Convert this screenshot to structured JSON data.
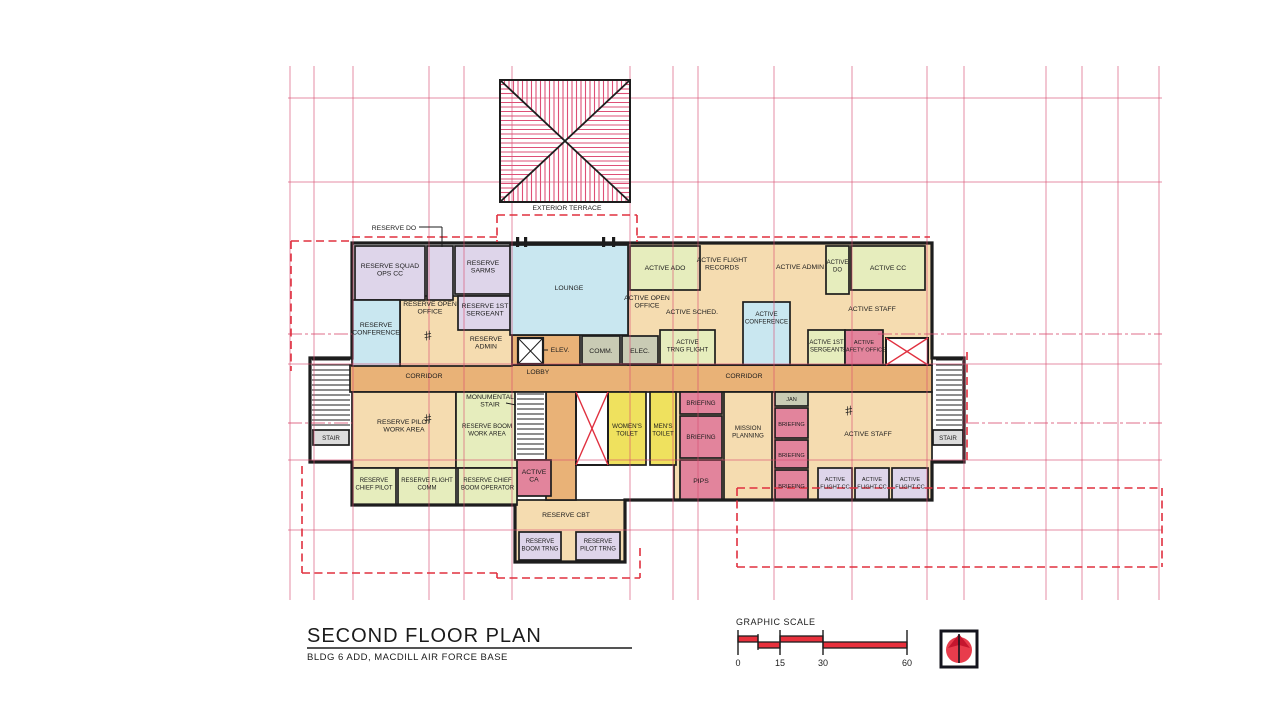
{
  "title_block": {
    "title": "SECOND FLOOR PLAN",
    "subtitle": "BLDG 6 ADD, MACDILL AIR FORCE BASE"
  },
  "scale_bar": {
    "label": "GRAPHIC SCALE",
    "ticks": [
      {
        "t": "0",
        "x": 738
      },
      {
        "t": "15",
        "x": 780
      },
      {
        "t": "30",
        "x": 823
      },
      {
        "t": "60",
        "x": 907
      }
    ],
    "half_tick_x": 758,
    "top_bars": [
      [
        738,
        758
      ],
      [
        780,
        823
      ]
    ],
    "bottom_bars": [
      [
        758,
        780
      ],
      [
        823,
        907
      ]
    ]
  },
  "colors": {
    "tan": "#f5dcb0",
    "corridor": "#e9b277",
    "green": "#e6edbd",
    "lavender": "#ded5ea",
    "blue": "#c9e7f0",
    "pink": "#e2849c",
    "yellow": "#efe15e",
    "gray": "#c9cbb4",
    "stair_gray": "#dcdcdc",
    "white": "#ffffff",
    "wall": "#1d1d1d",
    "grid": "#d84a6e",
    "dash_red": "#e0303f",
    "hatch": "#de5077"
  },
  "plan": {
    "grid": {
      "verticals": [
        290,
        314,
        353,
        429,
        464,
        512,
        630,
        673,
        698,
        774,
        852,
        927,
        964,
        1046,
        1082,
        1118,
        1159
      ],
      "v_extent": [
        66,
        600
      ],
      "horizontals": [
        98,
        182,
        364,
        460,
        530
      ],
      "h_extent": [
        288,
        1162
      ],
      "partials": [
        [
          288,
          334,
          352,
          334
        ],
        [
          878,
          334,
          1162,
          334
        ],
        [
          288,
          423,
          352,
          423
        ],
        [
          965,
          423,
          1162,
          423
        ]
      ]
    },
    "outline_path": "M352,243 H932 V358 H964 V462 H932 V500 H625 V562 H515 V505 H352 V462 H310 V358 H352 Z",
    "fills": [
      {
        "name": "corridor-main",
        "x": 350,
        "y": 365,
        "w": 582,
        "h": 27,
        "color": "corridor"
      },
      {
        "name": "lobby-upper",
        "x": 510,
        "y": 335,
        "w": 70,
        "h": 30,
        "color": "corridor"
      },
      {
        "name": "active-open-area",
        "x": 628,
        "y": 243,
        "w": 304,
        "h": 122,
        "color": "tan"
      },
      {
        "name": "reserve-open-area",
        "x": 400,
        "y": 296,
        "w": 112,
        "h": 70,
        "color": "tan"
      },
      {
        "name": "bottom-right-open-area",
        "x": 674,
        "y": 392,
        "w": 258,
        "h": 108,
        "color": "tan"
      },
      {
        "name": "room-reserve-cbt",
        "x": 515,
        "y": 500,
        "w": 110,
        "h": 62,
        "color": "tan"
      },
      {
        "name": "corridor-vertical",
        "x": 546,
        "y": 392,
        "w": 30,
        "h": 108,
        "color": "corridor"
      },
      {
        "name": "room-reserve-squad-ops-cc",
        "x": 355,
        "y": 246,
        "w": 70,
        "h": 54,
        "color": "lavender",
        "label": [
          "RESERVE SQUAD",
          "OPS CC"
        ],
        "ly": 268
      },
      {
        "name": "room-reserve-do",
        "x": 427,
        "y": 246,
        "w": 26,
        "h": 54,
        "color": "lavender"
      },
      {
        "name": "room-reserve-sarms",
        "x": 455,
        "y": 246,
        "w": 56,
        "h": 48,
        "color": "lavender",
        "label": [
          "RESERVE",
          "SARMS"
        ],
        "ly": 265
      },
      {
        "name": "room-reserve-conference",
        "x": 352,
        "y": 300,
        "w": 48,
        "h": 66,
        "color": "blue",
        "label": [
          "RESERVE",
          "CONFERENCE"
        ],
        "ly": 327
      },
      {
        "name": "room-reserve-1st-sergeant",
        "x": 458,
        "y": 296,
        "w": 54,
        "h": 34,
        "color": "lavender",
        "label": [
          "RESERVE 1ST",
          "SERGEANT"
        ],
        "ly": 308
      },
      {
        "name": "room-lounge",
        "x": 510,
        "y": 245,
        "w": 118,
        "h": 90,
        "color": "blue",
        "label": [
          "LOUNGE"
        ],
        "ly": 290
      },
      {
        "name": "room-active-ado",
        "x": 630,
        "y": 246,
        "w": 70,
        "h": 44,
        "color": "green",
        "label": [
          "ACTIVE ADO"
        ],
        "ly": 270
      },
      {
        "name": "room-active-do",
        "x": 826,
        "y": 246,
        "w": 23,
        "h": 48,
        "color": "green",
        "label": [
          "ACTIVE",
          "DO"
        ],
        "ly": 264,
        "fs": 6
      },
      {
        "name": "room-active-cc",
        "x": 851,
        "y": 246,
        "w": 74,
        "h": 44,
        "color": "green",
        "label": [
          "ACTIVE CC"
        ],
        "ly": 270
      },
      {
        "name": "room-active-conference",
        "x": 743,
        "y": 302,
        "w": 47,
        "h": 63,
        "color": "blue",
        "label": [
          "ACTIVE",
          "CONFERENCE"
        ],
        "ly": 316,
        "fs": 6.2
      },
      {
        "name": "room-active-1st-sergeant",
        "x": 808,
        "y": 330,
        "w": 37,
        "h": 35,
        "color": "green",
        "label": [
          "ACTIVE 1ST",
          "SERGEANT"
        ],
        "ly": 344,
        "fs": 6
      },
      {
        "name": "room-active-safety-office",
        "x": 845,
        "y": 330,
        "w": 38,
        "h": 35,
        "color": "pink",
        "label": [
          "ACTIVE",
          "SAFETY OFFICE"
        ],
        "ly": 344,
        "fs": 5.6
      },
      {
        "name": "room-comm",
        "x": 582,
        "y": 336,
        "w": 38,
        "h": 28,
        "color": "gray",
        "label": [
          "COMM."
        ],
        "ly": 353
      },
      {
        "name": "room-elec",
        "x": 622,
        "y": 336,
        "w": 36,
        "h": 28,
        "color": "gray",
        "label": [
          "ELEC."
        ],
        "ly": 353
      },
      {
        "name": "room-active-trng-flight",
        "x": 660,
        "y": 330,
        "w": 55,
        "h": 35,
        "color": "green",
        "label": [
          "ACTIVE",
          "TRNG FLIGHT"
        ],
        "ly": 344,
        "fs": 6.2
      },
      {
        "name": "room-reserve-pilot-work-area",
        "x": 352,
        "y": 392,
        "w": 104,
        "h": 76,
        "color": "tan",
        "label": [
          "RESERVE PILOT",
          "WORK AREA"
        ],
        "ly": 424
      },
      {
        "name": "room-reserve-boom-work-area",
        "x": 456,
        "y": 392,
        "w": 62,
        "h": 76,
        "color": "green",
        "label": [
          "RESERVE BOOM",
          "WORK AREA"
        ],
        "ly": 428,
        "fs": 6.2
      },
      {
        "name": "monumental-stair-well",
        "x": 515,
        "y": 392,
        "w": 31,
        "h": 68,
        "color": "white"
      },
      {
        "name": "room-active-ca",
        "x": 517,
        "y": 460,
        "w": 34,
        "h": 36,
        "color": "pink",
        "label": [
          "ACTIVE",
          "CA"
        ],
        "ly": 474
      },
      {
        "name": "room-womens-toilet",
        "x": 608,
        "y": 392,
        "w": 38,
        "h": 73,
        "color": "yellow",
        "label": [
          "WOMEN'S",
          "TOILET"
        ],
        "ly": 428,
        "fs": 6.2
      },
      {
        "name": "room-mens-toilet",
        "x": 650,
        "y": 392,
        "w": 26,
        "h": 73,
        "color": "yellow",
        "label": [
          "MEN'S",
          "TOILET"
        ],
        "ly": 428,
        "fs": 6.2
      },
      {
        "name": "room-briefing-1",
        "x": 680,
        "y": 392,
        "w": 42,
        "h": 22,
        "color": "pink",
        "label": [
          "BRIEFING"
        ],
        "ly": 405,
        "fs": 6.2
      },
      {
        "name": "room-briefing-2",
        "x": 680,
        "y": 416,
        "w": 42,
        "h": 42,
        "color": "pink",
        "label": [
          "BRIEFING"
        ],
        "ly": 439,
        "fs": 6.2
      },
      {
        "name": "room-pips",
        "x": 680,
        "y": 460,
        "w": 42,
        "h": 40,
        "color": "pink",
        "label": [
          "PIPS"
        ],
        "ly": 483
      },
      {
        "name": "room-mission-planning",
        "x": 724,
        "y": 392,
        "w": 48,
        "h": 108,
        "color": "tan",
        "label": [
          "MISSION",
          "PLANNING"
        ],
        "ly": 430,
        "fs": 6.2
      },
      {
        "name": "room-jan",
        "x": 775,
        "y": 392,
        "w": 33,
        "h": 14,
        "color": "gray",
        "label": [
          "JAN"
        ],
        "ly": 401,
        "fs": 5.6
      },
      {
        "name": "room-briefing-r1",
        "x": 775,
        "y": 408,
        "w": 33,
        "h": 30,
        "color": "pink",
        "label": [
          "BRIEFING"
        ],
        "ly": 426,
        "fs": 5.6
      },
      {
        "name": "room-briefing-r2",
        "x": 775,
        "y": 440,
        "w": 33,
        "h": 28,
        "color": "pink",
        "label": [
          "BRIEFING"
        ],
        "ly": 457,
        "fs": 5.6
      },
      {
        "name": "room-briefing-r3",
        "x": 775,
        "y": 470,
        "w": 33,
        "h": 30,
        "color": "pink",
        "label": [
          "BRIEFING"
        ],
        "ly": 488,
        "fs": 5.6
      },
      {
        "name": "room-active-flight-cc-1",
        "x": 818,
        "y": 468,
        "w": 34,
        "h": 32,
        "color": "lavender",
        "label": [
          "ACTIVE",
          "FLIGHT CC"
        ],
        "ly": 481,
        "fs": 5.6
      },
      {
        "name": "room-active-flight-cc-2",
        "x": 855,
        "y": 468,
        "w": 34,
        "h": 32,
        "color": "lavender",
        "label": [
          "ACTIVE",
          "FLIGHT CC"
        ],
        "ly": 481,
        "fs": 5.6
      },
      {
        "name": "room-active-flight-cc-3",
        "x": 892,
        "y": 468,
        "w": 36,
        "h": 32,
        "color": "lavender",
        "label": [
          "ACTIVE",
          "FLIGHT CC"
        ],
        "ly": 481,
        "fs": 5.6
      },
      {
        "name": "room-reserve-chief-pilot",
        "x": 352,
        "y": 468,
        "w": 44,
        "h": 37,
        "color": "green",
        "label": [
          "RESERVE",
          "CHIEF PILOT"
        ],
        "ly": 482,
        "fs": 6
      },
      {
        "name": "room-reserve-flight-comm",
        "x": 398,
        "y": 468,
        "w": 58,
        "h": 37,
        "color": "green",
        "label": [
          "RESERVE FLIGHT",
          "COMM"
        ],
        "ly": 482,
        "fs": 6
      },
      {
        "name": "room-reserve-chief-boom-operator",
        "x": 458,
        "y": 468,
        "w": 59,
        "h": 37,
        "color": "green",
        "label": [
          "RESERVE CHIEF",
          "BOOM OPERATOR"
        ],
        "ly": 482,
        "fs": 6
      },
      {
        "name": "room-reserve-boom-trng",
        "x": 519,
        "y": 532,
        "w": 42,
        "h": 28,
        "color": "lavender",
        "label": [
          "RESERVE",
          "BOOM TRNG"
        ],
        "ly": 543,
        "fs": 6
      },
      {
        "name": "room-reserve-pilot-trng",
        "x": 576,
        "y": 532,
        "w": 44,
        "h": 28,
        "color": "lavender",
        "label": [
          "RESERVE",
          "PILOT TRNG"
        ],
        "ly": 543,
        "fs": 6
      },
      {
        "name": "stair-label-left",
        "x": 313,
        "y": 430,
        "w": 36,
        "h": 15,
        "color": "stair_gray",
        "label": [
          "STAIR"
        ],
        "ly": 440,
        "fs": 6.2
      },
      {
        "name": "stair-label-right",
        "x": 933,
        "y": 430,
        "w": 30,
        "h": 15,
        "color": "stair_gray",
        "label": [
          "STAIR"
        ],
        "ly": 440,
        "fs": 6.2
      }
    ],
    "free_labels": [
      {
        "name": "label-reserve-open-office",
        "lines": [
          "RESERVE OPEN",
          "OFFICE"
        ],
        "x": 430,
        "y": 306
      },
      {
        "name": "label-reserve-admin",
        "lines": [
          "RESERVE",
          "ADMIN"
        ],
        "x": 486,
        "y": 341
      },
      {
        "name": "label-active-flight-records",
        "lines": [
          "ACTIVE FLIGHT",
          "RECORDS"
        ],
        "x": 722,
        "y": 262
      },
      {
        "name": "label-active-admin",
        "lines": [
          "ACTIVE ADMIN"
        ],
        "x": 800,
        "y": 269
      },
      {
        "name": "label-active-open-office",
        "lines": [
          "ACTIVE OPEN",
          "OFFICE"
        ],
        "x": 647,
        "y": 300
      },
      {
        "name": "label-active-sched",
        "lines": [
          "ACTIVE SCHED."
        ],
        "x": 692,
        "y": 314
      },
      {
        "name": "label-active-staff-top",
        "lines": [
          "ACTIVE STAFF"
        ],
        "x": 872,
        "y": 311
      },
      {
        "name": "label-active-staff-bottom",
        "lines": [
          "ACTIVE STAFF"
        ],
        "x": 868,
        "y": 436
      },
      {
        "name": "label-corridor-left",
        "lines": [
          "CORRIDOR"
        ],
        "x": 424,
        "y": 378
      },
      {
        "name": "label-lobby",
        "lines": [
          "LOBBY"
        ],
        "x": 538,
        "y": 374
      },
      {
        "name": "label-corridor-right",
        "lines": [
          "CORRIDOR"
        ],
        "x": 744,
        "y": 378
      },
      {
        "name": "label-reserve-cbt",
        "lines": [
          "RESERVE CBT"
        ],
        "x": 566,
        "y": 517
      },
      {
        "name": "label-exterior-terrace",
        "lines": [
          "EXTERIOR TERRACE"
        ],
        "x": 567,
        "y": 210
      },
      {
        "name": "label-reserve-do",
        "lines": [
          "RESERVE DO"
        ],
        "x": 394,
        "y": 230
      },
      {
        "name": "label-elev",
        "lines": [
          "ELEV."
        ],
        "x": 560,
        "y": 352
      },
      {
        "name": "label-monumental-stair",
        "lines": [
          "MONUMENTAL",
          "STAIR"
        ],
        "x": 490,
        "y": 399
      }
    ],
    "stairs": [
      {
        "x": 312,
        "y": 360,
        "w": 38,
        "h": 70,
        "step": 5
      },
      {
        "x": 936,
        "y": 360,
        "w": 26,
        "h": 70,
        "step": 5
      },
      {
        "x": 517,
        "y": 394,
        "w": 27,
        "h": 64,
        "step": 5
      }
    ],
    "xboxes": [
      {
        "x": 576,
        "y": 392,
        "w": 32,
        "h": 73
      },
      {
        "x": 886,
        "y": 338,
        "w": 42,
        "h": 27
      }
    ],
    "elevator": {
      "x": 518,
      "y": 338,
      "w": 25,
      "h": 26
    },
    "dashed": [
      [
        497,
        215,
        637,
        215
      ],
      [
        497,
        215,
        497,
        242
      ],
      [
        637,
        215,
        637,
        242
      ],
      [
        352,
        237,
        497,
        237
      ],
      [
        637,
        237,
        930,
        237
      ],
      [
        291,
        241,
        350,
        241
      ],
      [
        291,
        241,
        291,
        371
      ],
      [
        302,
        466,
        302,
        573
      ],
      [
        302,
        573,
        497,
        573
      ],
      [
        497,
        573,
        497,
        578
      ],
      [
        497,
        578,
        640,
        578
      ],
      [
        640,
        548,
        640,
        578
      ],
      [
        737,
        488,
        1162,
        488
      ],
      [
        1162,
        488,
        1162,
        567
      ],
      [
        737,
        567,
        1162,
        567
      ],
      [
        737,
        488,
        737,
        567
      ],
      [
        967,
        352,
        967,
        464
      ]
    ],
    "door_marks": [
      [
        516,
        237
      ],
      [
        524,
        237
      ],
      [
        602,
        237
      ],
      [
        612,
        237
      ]
    ],
    "hashes": [
      [
        428,
        336
      ],
      [
        428,
        419
      ],
      [
        849,
        411
      ]
    ],
    "leaders": [
      [
        419,
        227,
        442,
        227
      ],
      [
        442,
        227,
        442,
        247
      ],
      [
        548,
        350,
        543,
        350
      ],
      [
        506,
        403,
        516,
        405
      ]
    ],
    "roof": {
      "x": 500,
      "y": 80,
      "w": 130,
      "h": 122,
      "spacing": 4.5
    }
  }
}
